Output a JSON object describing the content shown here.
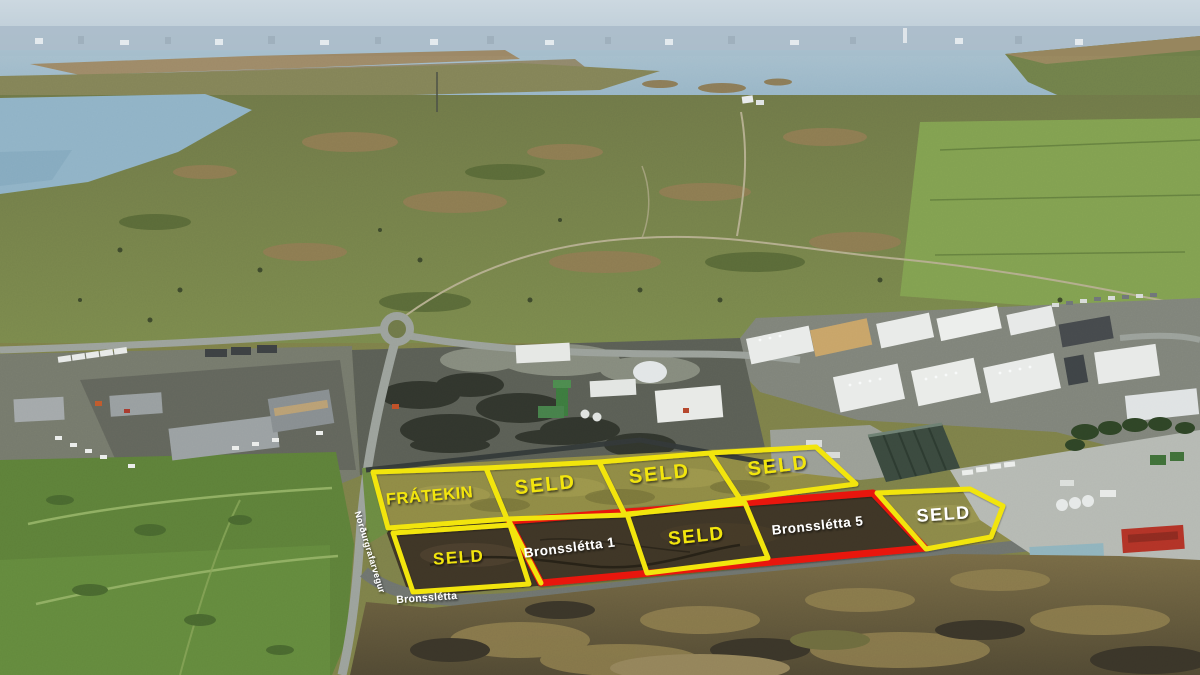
{
  "scene": {
    "type": "aerial-photo-plot-map",
    "area_label": "Bronsslétta industrial plots"
  },
  "overlay": {
    "colors": {
      "yellow": "#f2e50e",
      "red": "#e8170c",
      "white": "#ffffff"
    },
    "plots": [
      {
        "name": "street-parcel-bronssletta",
        "outline": "red",
        "stroke_width": 7,
        "points": "509,521 873,493 925,548 541,583"
      },
      {
        "name": "plot-fratekin",
        "outline": "yellow",
        "stroke_width": 5,
        "points": "373,472 486,468 507,519 388,528"
      },
      {
        "name": "plot-seld-top-1",
        "outline": "yellow",
        "stroke_width": 5,
        "points": "486,468 599,462 625,515 507,519"
      },
      {
        "name": "plot-seld-top-2",
        "outline": "yellow",
        "stroke_width": 5,
        "points": "599,462 710,453 740,499 625,515"
      },
      {
        "name": "plot-seld-top-3",
        "outline": "yellow",
        "stroke_width": 5,
        "points": "710,453 816,447 856,484 740,499"
      },
      {
        "name": "plot-seld-bottom-left",
        "outline": "yellow",
        "stroke_width": 5,
        "points": "393,533 510,525 529,584 413,592"
      },
      {
        "name": "plot-seld-bottom-middle",
        "outline": "yellow",
        "stroke_width": 5,
        "points": "627,514 745,503 768,558 647,573"
      },
      {
        "name": "plot-seld-right",
        "outline": "yellow",
        "stroke_width": 5,
        "points": "877,493 970,489 1003,506 991,537 926,549"
      }
    ],
    "lines": [
      {
        "name": "bronssletta-1-west-edge",
        "color": "yellow",
        "stroke_width": 5,
        "points": "509,521 541,583"
      }
    ],
    "labels": [
      {
        "name": "label-fratekin",
        "text": "FRÁTEKIN",
        "x": 430,
        "y": 501,
        "rotate": -5,
        "size": 16.5,
        "color": "yellow",
        "spacing": 0.5
      },
      {
        "name": "label-seld-top-1",
        "text": "SELD",
        "x": 546,
        "y": 491,
        "rotate": -6,
        "size": 20,
        "color": "yellow",
        "spacing": 2
      },
      {
        "name": "label-seld-top-2",
        "text": "SELD",
        "x": 660,
        "y": 480,
        "rotate": -6,
        "size": 20,
        "color": "yellow",
        "spacing": 2
      },
      {
        "name": "label-seld-top-3",
        "text": "SELD",
        "x": 779,
        "y": 472,
        "rotate": -7,
        "size": 20,
        "color": "yellow",
        "spacing": 2
      },
      {
        "name": "label-seld-bottom-left",
        "text": "SELD",
        "x": 459,
        "y": 563,
        "rotate": -4,
        "size": 17,
        "color": "yellow",
        "spacing": 1.5
      },
      {
        "name": "label-seld-bottom-middle",
        "text": "SELD",
        "x": 697,
        "y": 542,
        "rotate": -6,
        "size": 19,
        "color": "yellow",
        "spacing": 1.5
      },
      {
        "name": "label-seld-right",
        "text": "SELD",
        "x": 944,
        "y": 520,
        "rotate": -4,
        "size": 18,
        "color": "white",
        "spacing": 1.5
      },
      {
        "name": "label-street-bronssletta-1",
        "text": "Bronsslétta 1",
        "x": 570,
        "y": 552,
        "rotate": -7,
        "size": 13.5,
        "color": "white",
        "spacing": 0.5
      },
      {
        "name": "label-street-bronssletta-5",
        "text": "Bronsslétta 5",
        "x": 818,
        "y": 530,
        "rotate": -6,
        "size": 13.5,
        "color": "white",
        "spacing": 0.5
      },
      {
        "name": "road-label-bronssletta",
        "text": "Bronsslétta",
        "x": 427,
        "y": 601,
        "rotate": -4,
        "size": 10.5,
        "color": "white",
        "spacing": 0.3
      },
      {
        "name": "road-label-nordurgrafarvegur",
        "text": "Norðurgrafarvegur",
        "x": 367,
        "y": 553,
        "rotate": 73,
        "size": 9,
        "color": "white",
        "spacing": 0.3
      }
    ]
  }
}
